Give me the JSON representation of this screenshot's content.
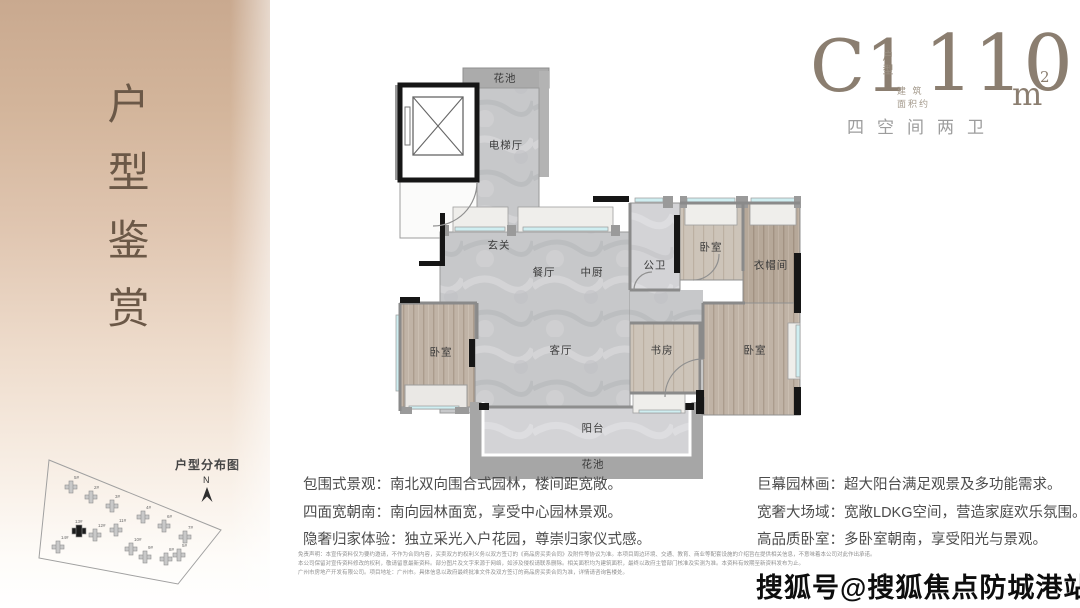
{
  "sidebar": {
    "title_vertical": "户型鉴赏",
    "siteplan": {
      "title": "户型分布图",
      "north_label": "N",
      "buildings": [
        "5#",
        "2#",
        "3#",
        "4#",
        "6#",
        "7#",
        "14#",
        "13#",
        "12#",
        "11#",
        "10#",
        "9#",
        "8#",
        "5#"
      ],
      "highlighted_building": "13#"
    }
  },
  "header": {
    "unit_code": "C1",
    "unit_code_tag": "户型",
    "area_prefix_line1": "建 筑",
    "area_prefix_line2": "面积约",
    "area_value": "110",
    "area_unit": "m",
    "area_sup": "2",
    "subtitle": "四空间两卫"
  },
  "floorplan": {
    "rooms": [
      "花池",
      "电梯厅",
      "玄关",
      "餐厅",
      "中厨",
      "公卫",
      "卧室",
      "衣帽间",
      "卧室",
      "客厅",
      "书房",
      "卧室",
      "阳台",
      "花池"
    ]
  },
  "features": {
    "left": [
      "包围式景观：南北双向围合式园林，楼间距宽敞。",
      "四面宽朝南：南向园林面宽，享受中心园林景观。",
      "隐奢归家体验：独立采光入户花园，尊崇归家仪式感。"
    ],
    "right": [
      "巨幕园林画：超大阳台满足观景及多功能需求。",
      "宽奢大场域：宽敞LDKG空间，营造家庭欢乐氛围。",
      "高品质卧室：多卧室朝南，享受阳光与景观。"
    ]
  },
  "disclaimer": [
    "免责声明：本宣传资料仅为要约邀请，不作为合同内容，买卖双方的权利义务以双方签订的《商品房买卖合同》及附件等协议为准。本项目周边环境、交通、教育、商业等配套设施的介绍旨在提供相关信息，不意味着本公司对此作出承诺。",
    "本公司保留对宣传资料修改的权利，敬请留意最新资料。部分图片及文字来源于网络，如涉及侵权请联系删除。相关面积均为建筑面积，最终以政府主管部门核准及实测为准。本资料有效期至新资料发布为止。",
    "广州市房地产开发有限公司。项目地址：广州市。具体信息以政府最终批准文件及双方签订的商品房买卖合同为准，详情请咨询售楼处。"
  ],
  "watermark": {
    "text": "搜狐号@搜狐焦点防城港站"
  },
  "colors": {
    "accent_brown": "#8b7e70",
    "sidebar_top": "#c9a98f",
    "marble": "#c7c8ca",
    "wood": "#c0b3a6",
    "wall_black": "#161616",
    "wall_gray": "#8a8a8a",
    "window_cyan": "#cfeef1"
  }
}
